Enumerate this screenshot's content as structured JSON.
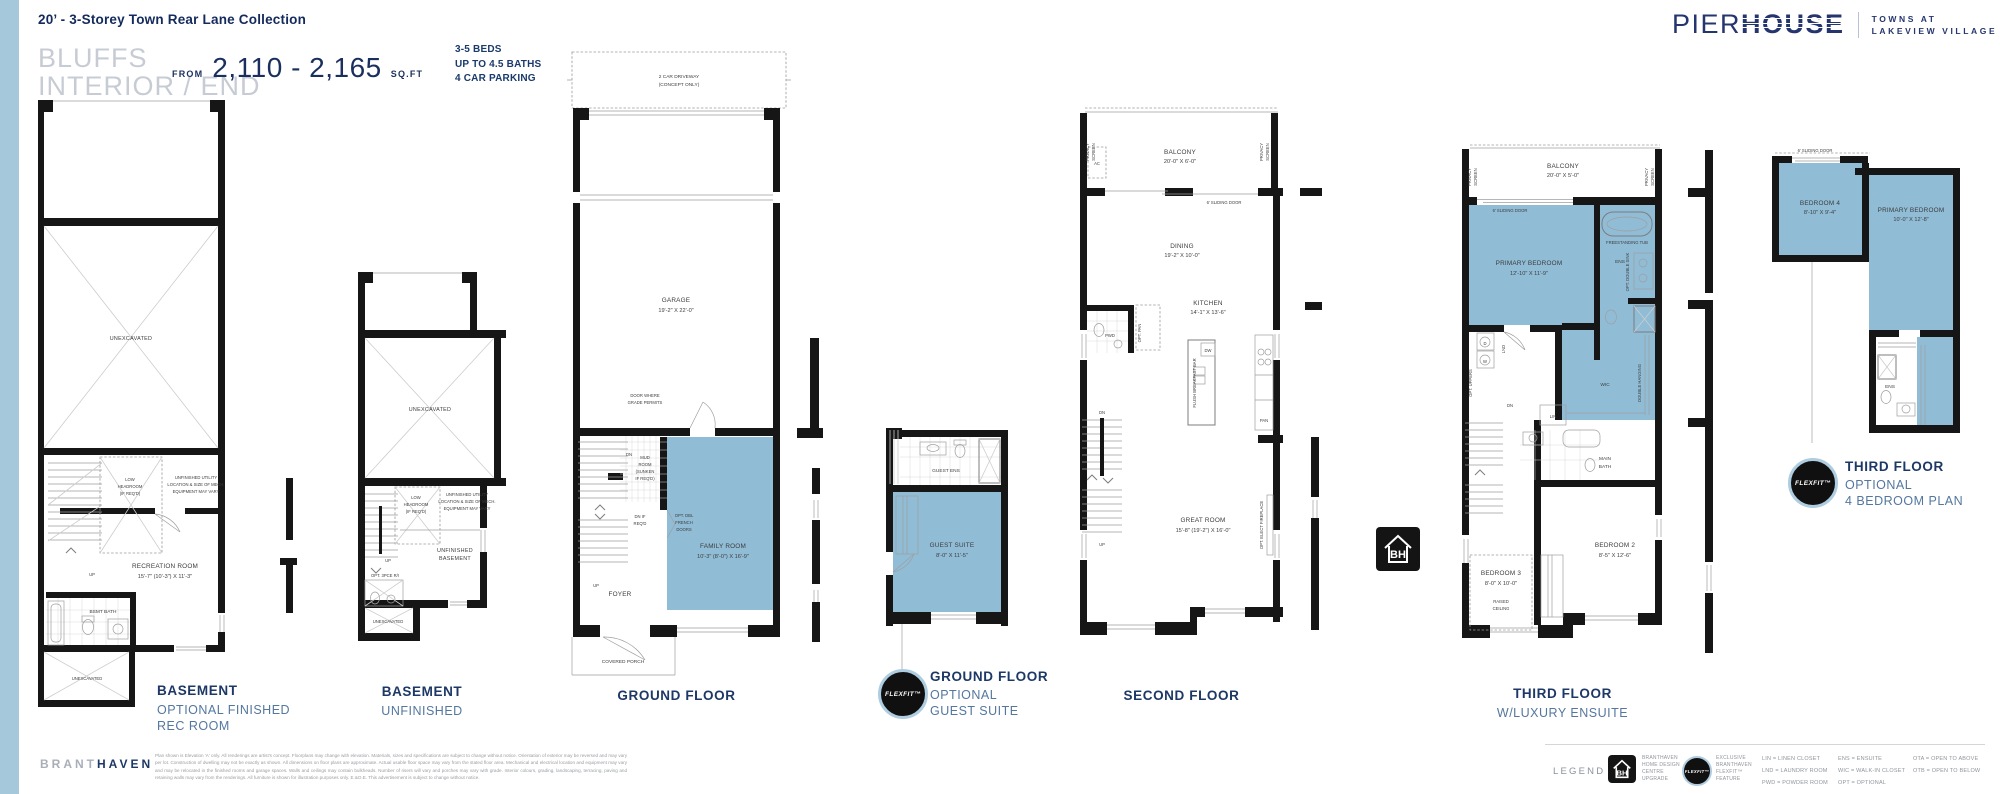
{
  "colors": {
    "navy": "#1d3866",
    "steel": "#54779e",
    "room_blue": "#90bcd6",
    "sidebar_blue": "#a5c8db"
  },
  "header": {
    "collection_title": "20’ - 3-Storey Town Rear Lane Collection",
    "plan_name_line1": "BLUFFS",
    "plan_name_line2": "INTERIOR / END",
    "from_label": "FROM",
    "sqft_range": "2,110 - 2,165",
    "sqft_unit": "SQ.FT",
    "specs": [
      "3-5 BEDS",
      "UP TO 4.5 BATHS",
      "4 CAR PARKING"
    ]
  },
  "brand": {
    "logo_part1": "PIER",
    "logo_part2": "HOUSE",
    "tagline_line1": "TOWNS AT",
    "tagline_line2": "LAKEVIEW VILLAGE"
  },
  "badges": {
    "flexfit": "FLEXFIT™",
    "bh": "BH"
  },
  "plans": {
    "basement_opt": {
      "caption": [
        "BASEMENT",
        "OPTIONAL FINISHED",
        "REC ROOM"
      ],
      "unexcavated_upper": "UNEXCAVATED",
      "unexcavated_lower": "UNEXCAVATED",
      "low_headroom": [
        "LOW",
        "HEADROOM",
        "(IF REQ'D)"
      ],
      "utility": [
        "UNFINISHED UTILITY",
        "LOCATION & SIZE OF MECH.",
        "EQUIPMENT MAY VARY"
      ],
      "rec_room_name": "RECREATION ROOM",
      "rec_room_dims": "15'-7\" (10'-3\") X 11'-3\"",
      "bsmt_bath": "BSMT BATH",
      "up": "UP"
    },
    "basement_unf": {
      "caption": [
        "BASEMENT",
        "UNFINISHED"
      ],
      "unexcavated_upper": "UNEXCAVATED",
      "unexcavated_lower": "UNEXCAVATED",
      "low_headroom": [
        "LOW",
        "HEADROOM",
        "(IF REQ'D)"
      ],
      "utility": [
        "UNFINISHED UTILITY",
        "LOCATION & SIZE OF MECH.",
        "EQUIPMENT MAY VARY"
      ],
      "room_name": [
        "UNFINISHED",
        "BASEMENT"
      ],
      "rough_in": "OPT. 3PCE R/I",
      "up": "UP"
    },
    "ground": {
      "caption": [
        "GROUND FLOOR"
      ],
      "driveway": [
        "2 CAR DRIVEWAY",
        "(CONCEPT ONLY)"
      ],
      "garage_name": "GARAGE",
      "garage_dims": "19'-2\" X 22'-0\"",
      "door_grade": [
        "DOOR WHERE",
        "GRADE PERMITS"
      ],
      "dn": "DN",
      "mud_room": [
        "MUD",
        "ROOM",
        "(SUNKEN",
        "IF REQ'D)"
      ],
      "dn_if_reqd": [
        "DN IF",
        "REQ'D"
      ],
      "french_doors": [
        "OPT. DBL",
        "FRENCH",
        "DOORS"
      ],
      "family_name": "FAMILY ROOM",
      "family_dims": "10'-3\" (8'-0\") X 16'-9\"",
      "foyer": "FOYER",
      "up": "UP",
      "porch": "COVERED PORCH"
    },
    "guest": {
      "caption": [
        "GROUND FLOOR",
        "OPTIONAL",
        "GUEST SUITE"
      ],
      "ens": "GUEST ENS",
      "suite_name": "GUEST SUITE",
      "suite_dims": "8'-0\" X 11'-5\""
    },
    "second": {
      "caption": [
        "SECOND FLOOR"
      ],
      "privacy": [
        "PRIVACY",
        "SCREEN"
      ],
      "ac": "AC",
      "balcony_name": "BALCONY",
      "balcony_dims": "20'-0\" X 6'-0\"",
      "sliding": "6' SLIDING DOOR",
      "dining_name": "DINING",
      "dining_dims": "19'-2\" X 10'-0\"",
      "kitchen_name": "KITCHEN",
      "kitchen_dims": "14'-1\" X 13'-6\"",
      "pwd": "PWD",
      "opt_pan": "OPT. PAN",
      "dw": "DW",
      "breakfast_bar": "FLUSH BREAKFAST BAR",
      "pan": "PAN",
      "dn": "DN",
      "up": "UP",
      "great_name": "GREAT ROOM",
      "great_dims": "15'-8\" (19'-2\") X 16'-0\"",
      "fireplace": "OPT. ELECT FIREPLACE"
    },
    "third": {
      "caption": [
        "THIRD FLOOR",
        "W/LUXURY ENSUITE"
      ],
      "privacy": [
        "PRIVACY",
        "SCREEN"
      ],
      "balcony_name": "BALCONY",
      "balcony_dims": "20'-0\" X 5'-0\"",
      "sliding": "6' SLIDING DOOR",
      "primary_name": "PRIMARY BEDROOM",
      "primary_dims": "12'-10\" X 11'-9\"",
      "tub": "FREESTANDING TUB",
      "ens": "ENS",
      "double_sink": "OPT. DOUBLE SINK",
      "wic": "WIC",
      "double_hanging": "DOUBLE HANGING",
      "opt_uppers": "OPT. UPPERS",
      "lnd": "LND",
      "washer": "W",
      "dryer": "D",
      "dn": "DN",
      "lin": "LIN",
      "main_bath": [
        "MAIN",
        "BATH"
      ],
      "bed2_name": "BEDROOM 2",
      "bed2_dims": "8'-5\" X 12'-6\"",
      "bed3_name": "BEDROOM 3",
      "bed3_dims": "8'-0\" X 10'-0\"",
      "raised": [
        "RAISED",
        "CEILING"
      ]
    },
    "fourbed": {
      "caption": [
        "THIRD FLOOR",
        "OPTIONAL",
        "4 BEDROOM PLAN"
      ],
      "sliding": "6' SLIDING DOOR",
      "bed4_name": "BEDROOM 4",
      "bed4_dims": "8'-10\" X 9'-4\"",
      "primary_name": "PRIMARY BEDROOM",
      "primary_dims": "10'-0\" X 12'-8\"",
      "ens": "ENS"
    }
  },
  "footer": {
    "brand_part1": "BRANT",
    "brand_part2": "HAVEN",
    "disclaimer": "Plan shown is Elevation 'A' only. All renderings are artist's concept. Floorplans may change with elevation. Materials, sizes and specifications are subject to change without notice. Orientation of exterior may be reversed and may vary per lot. Construction of dwelling may not be exactly as shown. All dimensions on floor plans are approximate. Actual usable floor space may vary from the stated floor area. Mechanical and electrical location and equipment may vary and may be relocated in the finished rooms and garage spaces. Walls and ceilings may contain bulkheads. Number of risers will vary and porches may vary with grade. Interior colours, grading, landscaping, terracing, paving and retaining walls may vary from the renderings. All furniture is shown for illustration purposes only. E.&O.E. This advertisement is subject to change without notice.",
    "legend_title": "LEGEND",
    "bh_lines": [
      "BRANTHAVEN",
      "HOME DESIGN",
      "CENTRE",
      "UPGRADE"
    ],
    "flexfit_lines": [
      "EXCLUSIVE",
      "BRANTHAVEN",
      "FLEXFIT™",
      "FEATURE"
    ],
    "abbr_col1": [
      "LIN = LINEN CLOSET",
      "LND = LAUNDRY ROOM",
      "PWD = POWDER ROOM"
    ],
    "abbr_col2": [
      "ENS = ENSUITE",
      "WIC = WALK-IN CLOSET",
      "OPT = OPTIONAL"
    ],
    "abbr_col3": [
      "OTA = OPEN TO ABOVE",
      "OTB = OPEN TO BELOW"
    ]
  }
}
